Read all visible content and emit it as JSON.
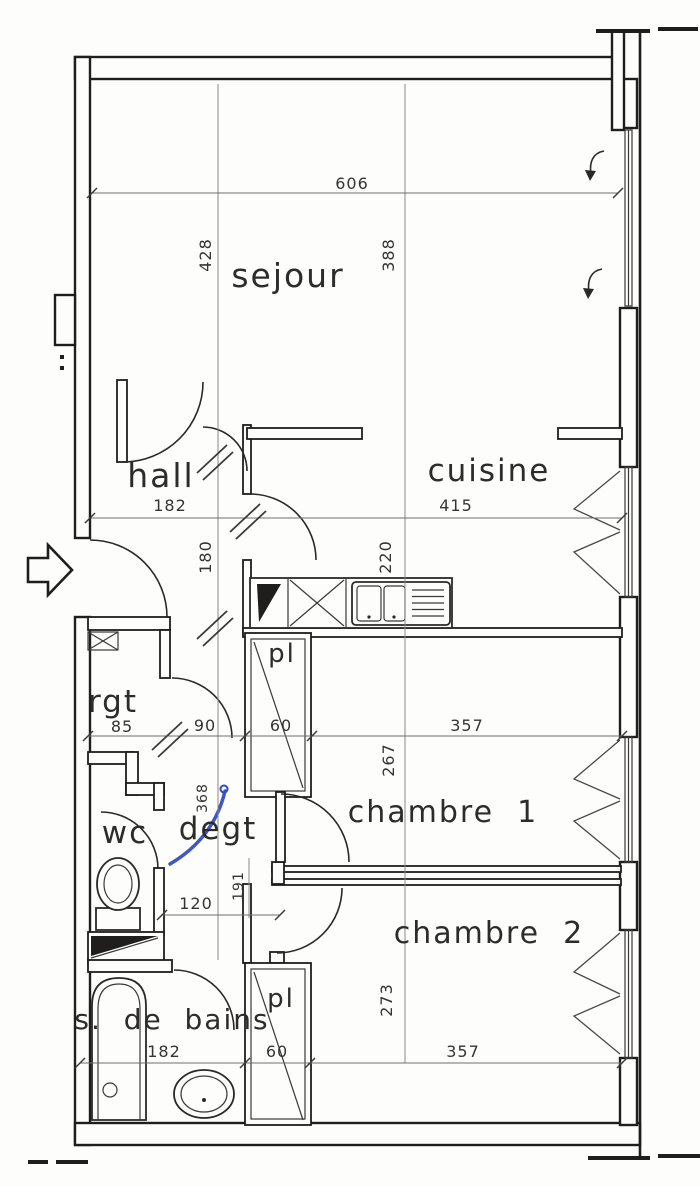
{
  "title": "floor-plan-scan",
  "rooms": {
    "sejour": {
      "label": "sejour"
    },
    "hall": {
      "label": "hall"
    },
    "cuisine": {
      "label": "cuisine"
    },
    "rgt": {
      "label": "rgt"
    },
    "pl_top": {
      "label": "pl"
    },
    "wc": {
      "label": "wc"
    },
    "degt": {
      "label": "degt"
    },
    "chambre1": {
      "label": "chambre  1"
    },
    "chambre2": {
      "label": "chambre  2"
    },
    "sdb": {
      "label": "s.  de  bains"
    },
    "pl_bottom": {
      "label": "pl"
    }
  },
  "dimensions": {
    "d606": "606",
    "d428": "428",
    "d388": "388",
    "d182_hall": "182",
    "d415": "415",
    "d180": "180",
    "d220": "220",
    "d85": "85",
    "d90": "90",
    "d60_top": "60",
    "d357_top": "357",
    "d267": "267",
    "d368": "368",
    "d191": "191",
    "d120": "120",
    "d273": "273",
    "d182_sdb": "182",
    "d60_bottom": "60",
    "d357_bottom": "357"
  },
  "colors": {
    "ink": "#1f1e1c",
    "paper": "#fdfdfb",
    "pen_blue": "#2f47c6"
  }
}
